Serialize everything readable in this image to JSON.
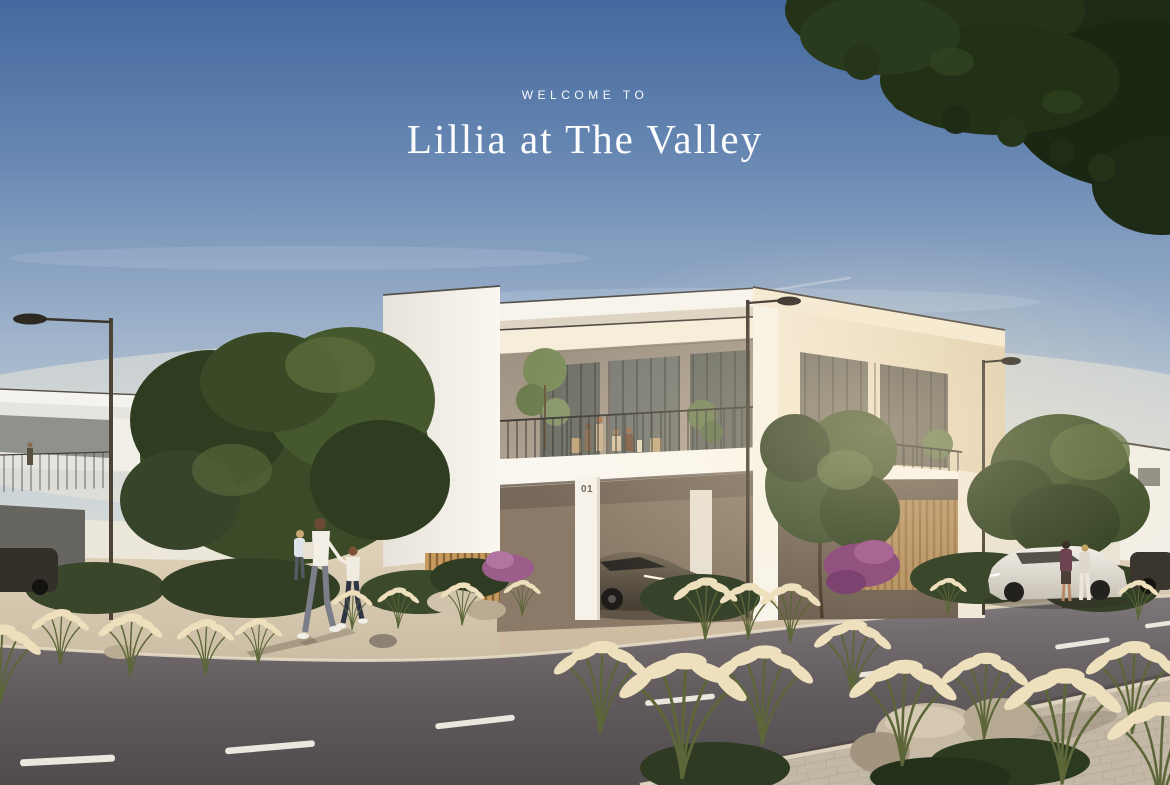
{
  "overlay": {
    "eyebrow": "WELCOME TO",
    "title": "Lillia at The Valley",
    "text_color": "#ffffff"
  },
  "scene": {
    "villa_number": "01",
    "palette": {
      "sky_top": "#44699e",
      "sky_mid": "#93aac6",
      "horizon_haze": "#ece6d8",
      "sunlit_white": "#f8f4ec",
      "warm_cream": "#f0e4cc",
      "shadow_white": "#d9d4ca",
      "foliage_dark": "#1d2a15",
      "foliage_mid": "#3b4b28",
      "road_asphalt": "#6b6467",
      "sidewalk_beige": "#d3c4a9",
      "paver_gray": "#c3b8a6",
      "grass_plume": "#eedfbd",
      "bougainvillea": "#9c5d8a",
      "lane_marking": "#ece7de",
      "wood_slat": "#c59a5c",
      "car_bronze": "#5e5446",
      "car_white": "#ece8e0"
    }
  }
}
